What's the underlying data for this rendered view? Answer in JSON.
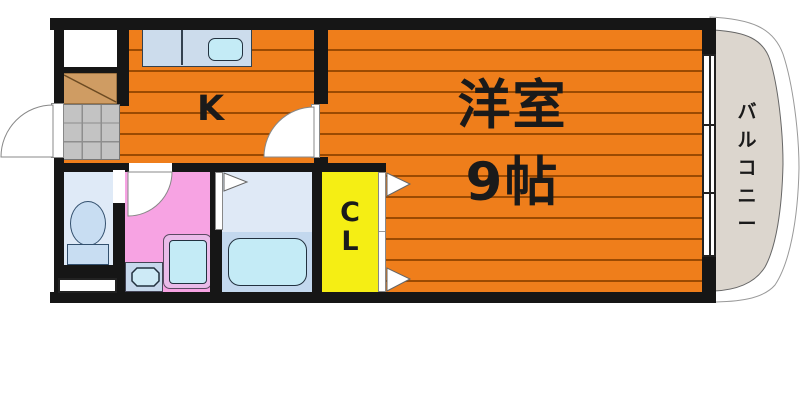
{
  "rooms": {
    "kitchen": {
      "label": "K"
    },
    "main_room": {
      "name": "洋室",
      "size": "9帖",
      "label": "洋室 9帖"
    },
    "closet": {
      "label": "CL",
      "chars": [
        "C",
        "L"
      ]
    },
    "balcony": {
      "label": "バルコニー",
      "chars": [
        "バ",
        "ル",
        "コ",
        "ニ",
        "ー"
      ]
    }
  },
  "colors": {
    "floor": "#ef7e1b",
    "floor-line": "#9b4a02",
    "wall": "#161616",
    "washroom-pink": "#f7a3e3",
    "closet-yellow": "#f5ee14",
    "balcony-beige": "#dcd6ce",
    "fixture-blue": "#ccdcec",
    "water-cyan": "#c4ebf6",
    "tile-gray": "#c3c3c3",
    "shoe-brown": "#cf9c63"
  }
}
